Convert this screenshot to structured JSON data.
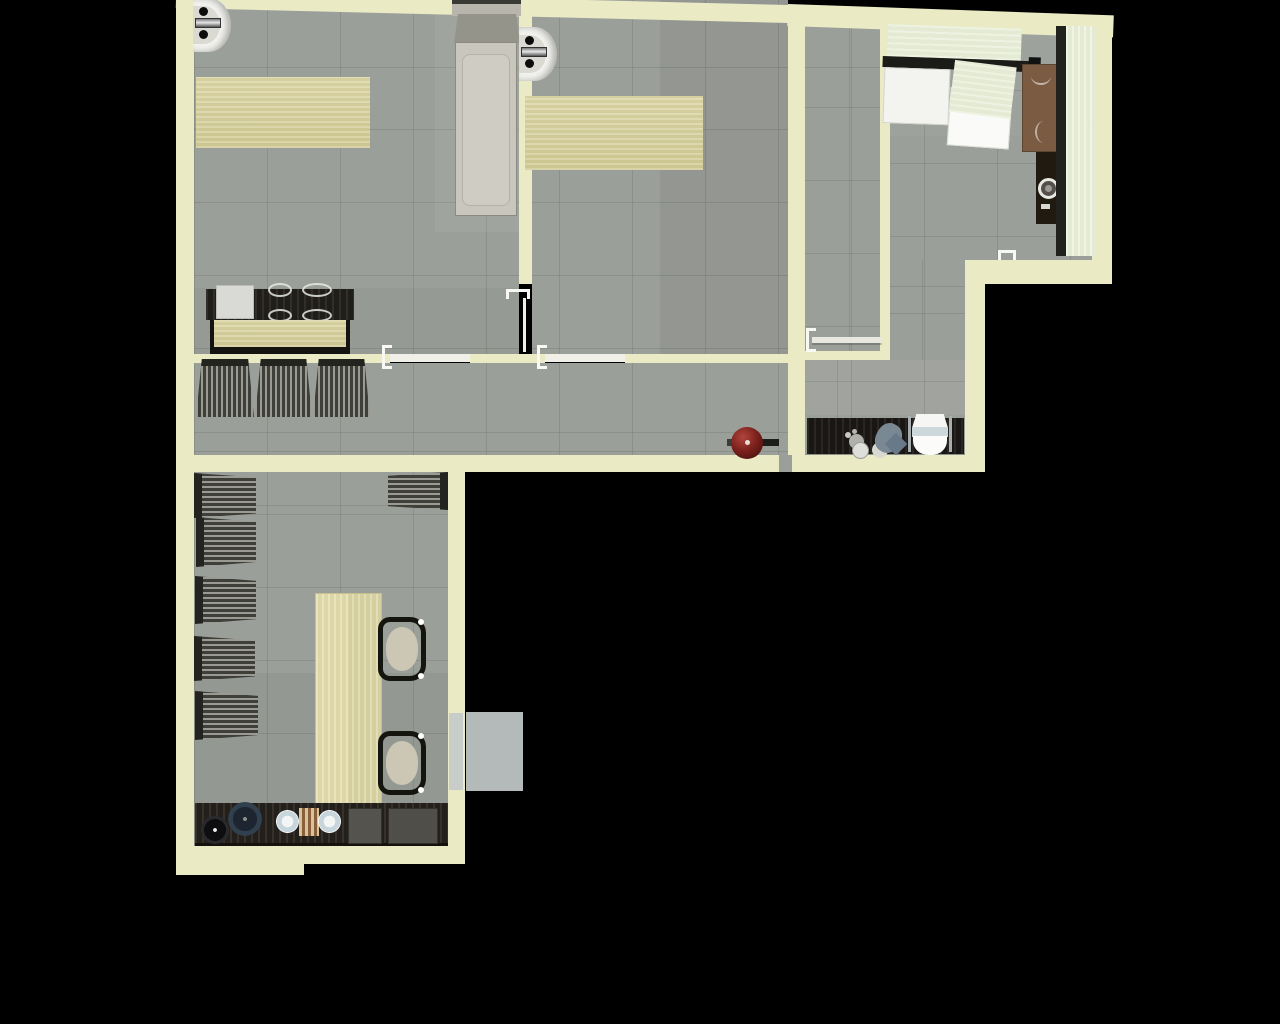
{
  "scene": {
    "kind": "apartment floor plan, top-down 3D render",
    "background": "#000000",
    "visible_text": "none",
    "rooms": [
      "bedroom-left",
      "bedroom-middle",
      "entry-hall",
      "kitchen",
      "bathroom",
      "corridor",
      "living-room"
    ]
  },
  "palette": {
    "outside": "#000000",
    "wall": "#eaebc5",
    "floor": "#9b9f99",
    "grid": "rgba(55,60,50,0.15)",
    "wood": "#ddd7a6",
    "wood-dark": "#d2cb96",
    "counter-green": "#e8efd7",
    "dark-wood": "#2b2620",
    "black-trim": "#1b1b17",
    "white": "#f2f2ee",
    "red": "#7e221d",
    "balcony": "#b3bab9",
    "window": "#c8cdca",
    "brown": "#7b5c43",
    "stripe-light": "#9a9a93",
    "stripe-dark": "#3f3f3a",
    "mattress": "#c9c7bd",
    "headboard": "#95948a",
    "toilet-seat": "#cdd8dd",
    "steel": "#a8aeb0",
    "cushion": "#ccc7b4",
    "stove": "#55534d",
    "pot-blue": "#1d2630",
    "board": "#d9c49a",
    "board-stripe": "#8a5f3c"
  },
  "inventory": {
    "bedroom-left": [
      "wall-basin",
      "wood-desk",
      "single-bed",
      "reception-desk",
      "paper-sheet",
      "wire-chairs"
    ],
    "bedroom-middle": [
      "wall-basin",
      "wood-desk"
    ],
    "entry-hall": [
      "open-door"
    ],
    "kitchen": [
      "counter-run",
      "counter-edge",
      "fridge",
      "counter-slab",
      "dishwasher",
      "side-table",
      "washing-machine",
      "tall-cabinet",
      "counter-strip"
    ],
    "bathroom": [
      "vanity-counter",
      "faucet",
      "washbasin",
      "stool-pad",
      "toilet"
    ],
    "corridor": [
      "striped-armchair",
      "striped-armchair",
      "striped-armchair",
      "charcoal-kettle"
    ],
    "living-room": [
      "striped-armchair",
      "striped-armchair",
      "striped-armchair",
      "striped-armchair",
      "striped-armchair",
      "striped-armchair",
      "dining-table",
      "desk-chair",
      "desk-chair",
      "kitchen-counter",
      "stock-pot",
      "saucepan",
      "plate",
      "plate",
      "cutting-board",
      "cooktop",
      "oven-square",
      "window",
      "balcony-slab"
    ],
    "doors": [
      "door-a-threshold",
      "door-b-threshold",
      "divider-door",
      "hall-door",
      "kitchen-door",
      "service-notch"
    ]
  },
  "counts": {
    "rooms": 7,
    "striped_armchairs": 9,
    "desks_tables": 5,
    "beds": 1,
    "doors_marked": 5
  }
}
